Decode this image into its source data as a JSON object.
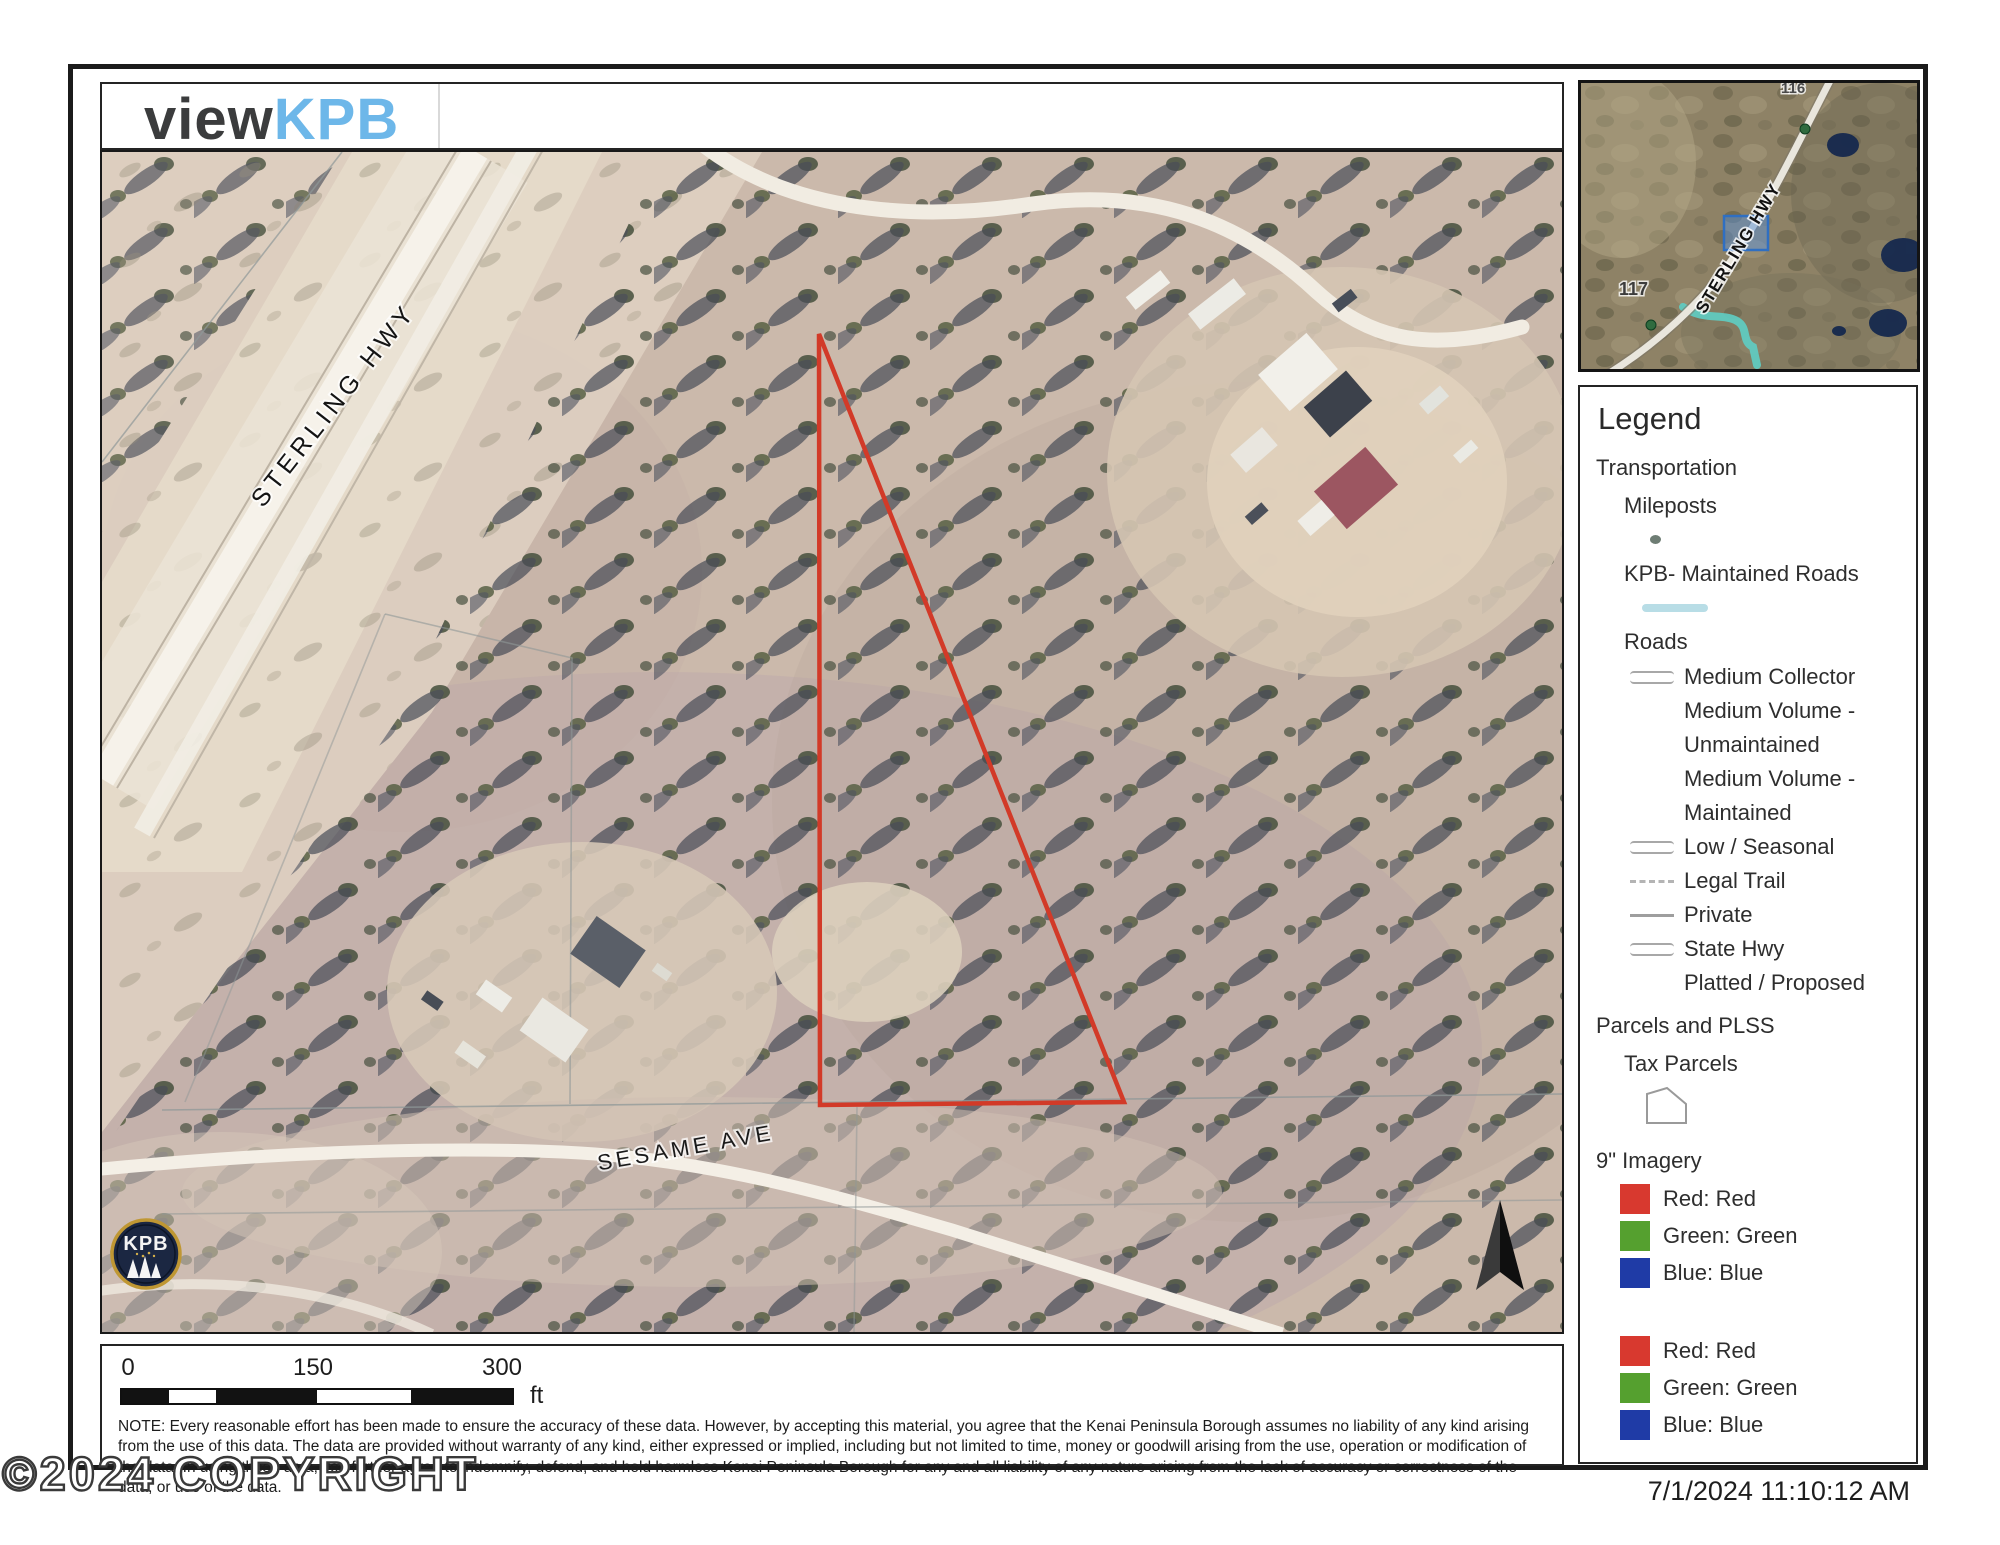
{
  "header": {
    "logo_view": "view",
    "logo_kpb": "KPB"
  },
  "main_map": {
    "highway_label": "STERLING HWY",
    "street_label": "SESAME AVE",
    "logo_text": "KPB"
  },
  "inset_map": {
    "highway_label": "STERLING HWY",
    "milepost_label": "117",
    "milepost_label_top": "116"
  },
  "legend": {
    "title": "Legend",
    "transportation": {
      "label": "Transportation",
      "mileposts": "Mileposts",
      "kpb_roads": "KPB- Maintained Roads",
      "roads": "Roads",
      "road_types": {
        "medium_collector": "Medium Collector",
        "medium_volume_unmaintained_line1": "Medium Volume -",
        "medium_volume_unmaintained_line2": "Unmaintained",
        "medium_volume_maintained_line1": "Medium Volume -",
        "medium_volume_maintained_line2": "Maintained",
        "low_seasonal": "Low / Seasonal",
        "legal_trail": "Legal Trail",
        "private_road": "Private",
        "state_hwy": "State Hwy",
        "platted_proposed": "Platted / Proposed"
      }
    },
    "parcels_plss": {
      "label": "Parcels and PLSS",
      "tax_parcels": "Tax Parcels"
    },
    "imagery": {
      "label": "9\" Imagery",
      "group1": {
        "red": "Red: Red",
        "green": "Green: Green",
        "blue": "Blue: Blue"
      },
      "group2": {
        "red": "Red: Red",
        "green": "Green: Green",
        "blue": "Blue: Blue"
      }
    }
  },
  "scale_bar": {
    "tick_0": "0",
    "tick_150": "150",
    "tick_300": "300",
    "unit": "ft"
  },
  "disclaimer": "NOTE: Every reasonable effort has been made to ensure the accuracy of these data. However, by accepting this material, you agree that the Kenai Peninsula Borough assumes no liability of any kind arising from the use of this data. The data are provided without warranty of any kind, either expressed or implied, including but not limited to time, money or goodwill arising from the use, operation or modification of the data.  In using these data, you further agree to indemnify, defend, and hold harmless Kenai Peninsula Borough for any and all liability of any nature arising from the lack of accuracy or correctness of the data, or use of the data.",
  "footer": {
    "timestamp": "7/1/2024 11:10:12 AM",
    "copyright": "©2024 COPYRIGHT"
  },
  "colors": {
    "parcel_outline_red": "#d23a28",
    "extent_blue": "#3c7fd0",
    "kpb_maintained_teal": "#5fccc2",
    "logo_blue": "#6db7e9",
    "swatch_red": "#d8392f",
    "swatch_green": "#55a02f",
    "swatch_blue": "#1f3ba6"
  }
}
